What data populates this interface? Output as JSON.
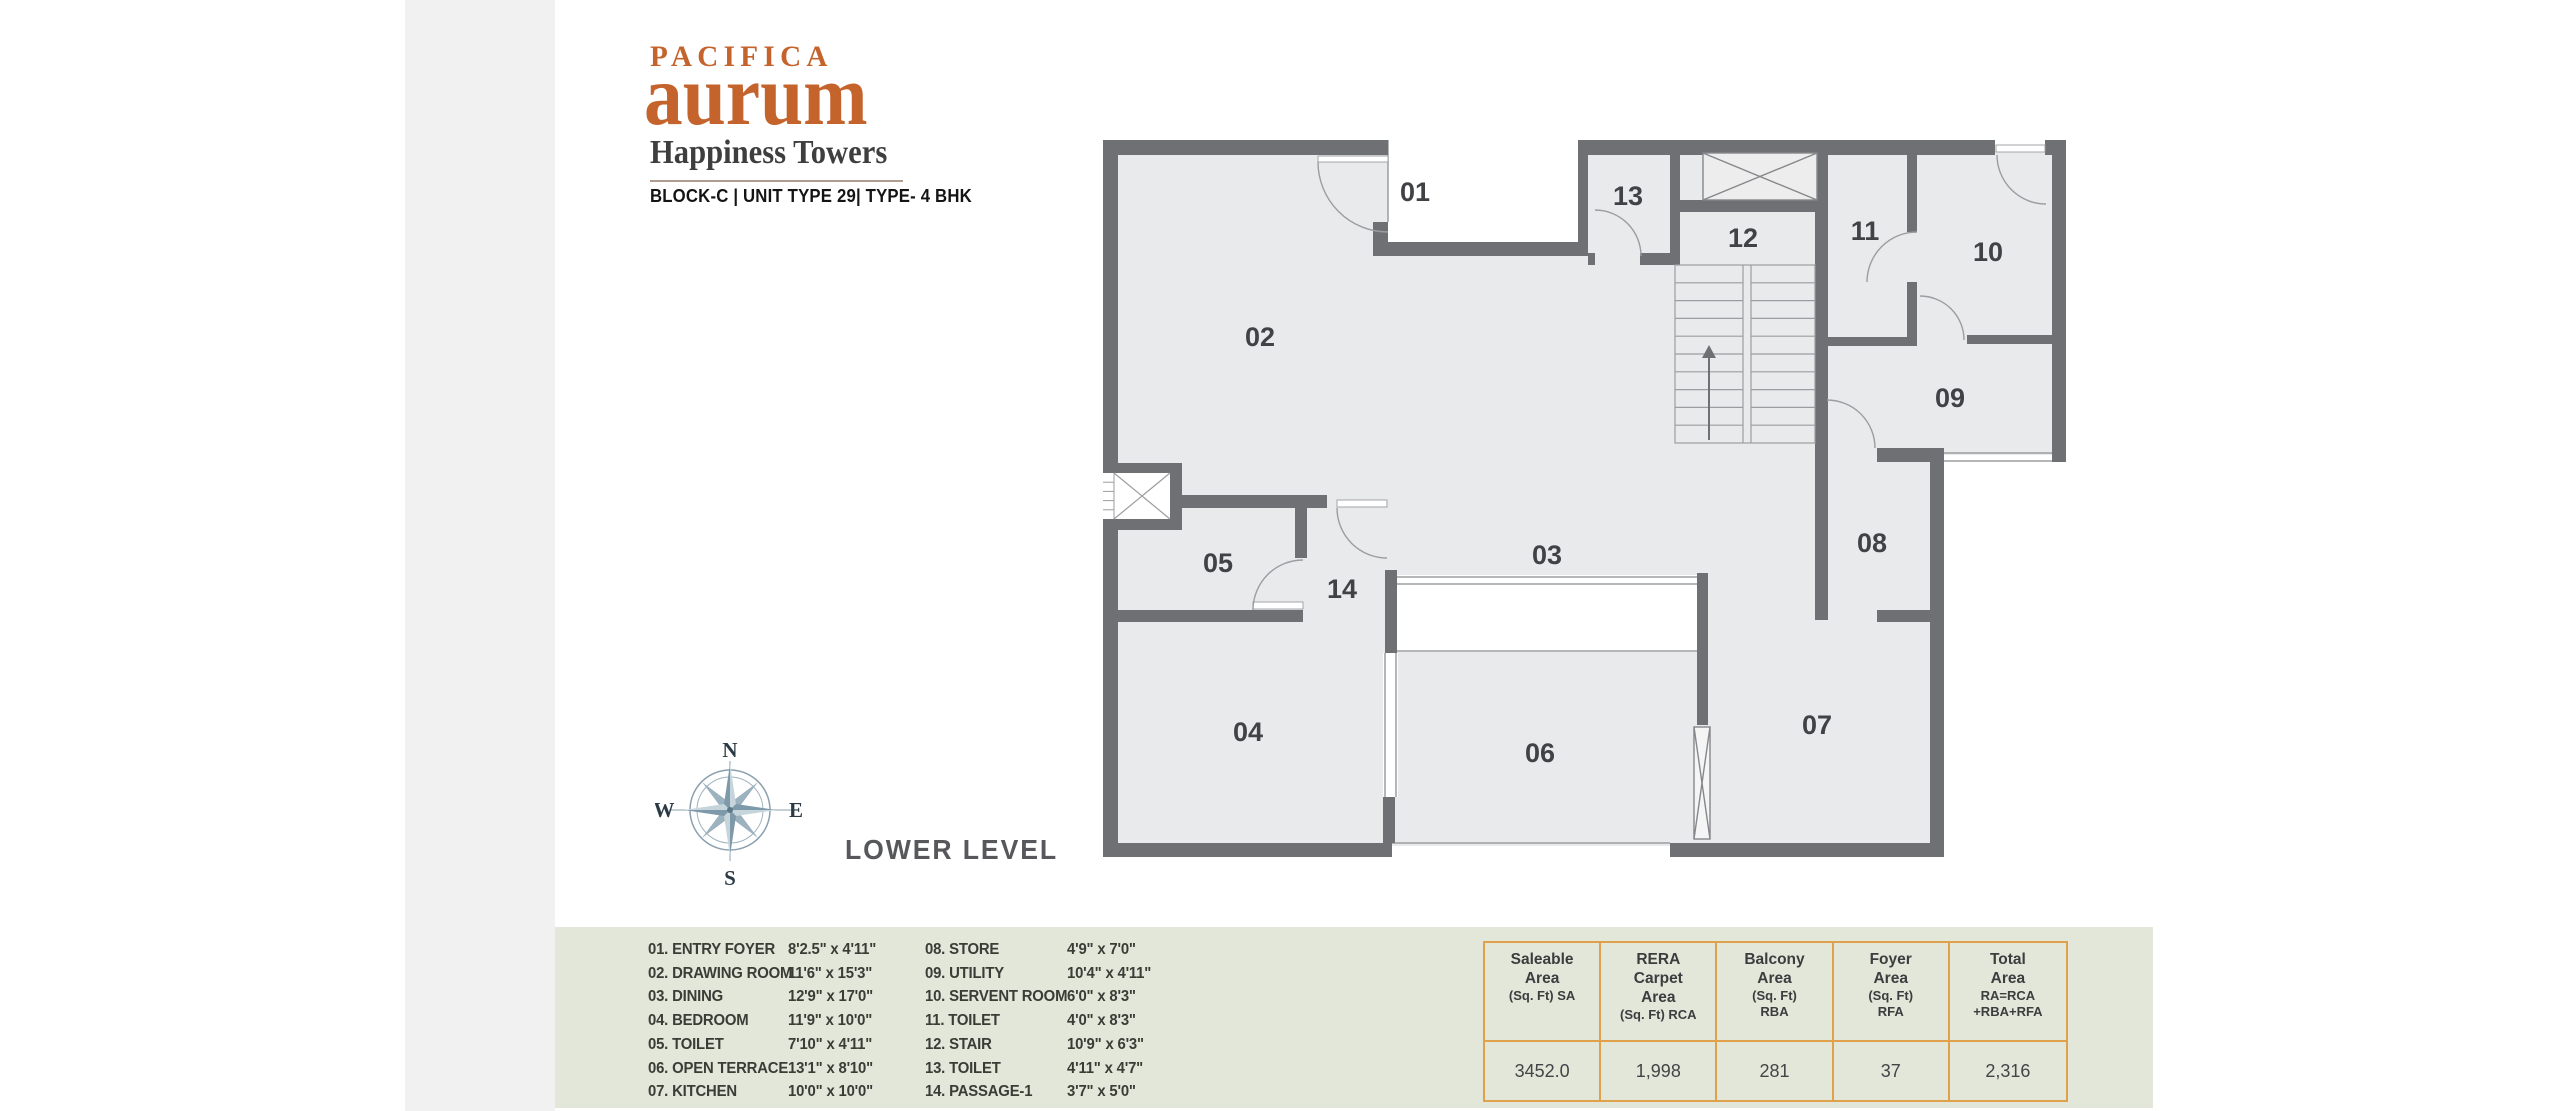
{
  "brand": {
    "line1": "PACIFICA",
    "line2": "aurum",
    "line3": "Happiness Towers",
    "line4": "BLOCK-C | UNIT TYPE 29| TYPE- 4 BHK"
  },
  "level_label": "LOWER LEVEL",
  "compass": {
    "n": "N",
    "e": "E",
    "s": "S",
    "w": "W"
  },
  "plan": {
    "rooms": [
      {
        "id": "01",
        "x": 1415,
        "y": 192
      },
      {
        "id": "02",
        "x": 1260,
        "y": 337
      },
      {
        "id": "03",
        "x": 1547,
        "y": 555
      },
      {
        "id": "04",
        "x": 1248,
        "y": 732
      },
      {
        "id": "05",
        "x": 1218,
        "y": 563
      },
      {
        "id": "06",
        "x": 1540,
        "y": 753
      },
      {
        "id": "07",
        "x": 1817,
        "y": 725
      },
      {
        "id": "08",
        "x": 1872,
        "y": 543
      },
      {
        "id": "09",
        "x": 1950,
        "y": 398
      },
      {
        "id": "10",
        "x": 1988,
        "y": 252
      },
      {
        "id": "11",
        "x": 1865,
        "y": 231
      },
      {
        "id": "12",
        "x": 1743,
        "y": 238
      },
      {
        "id": "13",
        "x": 1628,
        "y": 196
      },
      {
        "id": "14",
        "x": 1342,
        "y": 589
      }
    ]
  },
  "legend": {
    "left": [
      {
        "num": "01.",
        "name": "ENTRY FOYER",
        "dim": "8'2.5\" x 4'11\""
      },
      {
        "num": "02.",
        "name": "DRAWING ROOM",
        "dim": "11'6\" x 15'3\""
      },
      {
        "num": "03.",
        "name": "DINING",
        "dim": "12'9\" x 17'0\""
      },
      {
        "num": "04.",
        "name": "BEDROOM",
        "dim": "11'9\" x 10'0\""
      },
      {
        "num": "05.",
        "name": "TOILET",
        "dim": "7'10\" x 4'11\""
      },
      {
        "num": "06.",
        "name": "OPEN TERRACE",
        "dim": "13'1\" x 8'10\""
      },
      {
        "num": "07.",
        "name": "KITCHEN",
        "dim": "10'0\" x 10'0\""
      }
    ],
    "right": [
      {
        "num": "08.",
        "name": "STORE",
        "dim": "4'9\" x 7'0\""
      },
      {
        "num": "09.",
        "name": "UTILITY",
        "dim": "10'4\" x 4'11\""
      },
      {
        "num": "10.",
        "name": "SERVENT ROOM",
        "dim": "6'0\" x 8'3\""
      },
      {
        "num": "11.",
        "name": "TOILET",
        "dim": "4'0\" x 8'3\""
      },
      {
        "num": "12.",
        "name": "STAIR",
        "dim": "10'9\" x 6'3\""
      },
      {
        "num": "13.",
        "name": "TOILET",
        "dim": "4'11\" x 4'7\""
      },
      {
        "num": "14.",
        "name": "PASSAGE-1",
        "dim": "3'7\" x 5'0\""
      }
    ]
  },
  "area_table": {
    "columns": [
      {
        "title_lines": [
          "Saleable",
          "Area"
        ],
        "sub_lines": [
          "(Sq. Ft) SA"
        ],
        "value": "3452.0"
      },
      {
        "title_lines": [
          "RERA",
          "Carpet",
          "Area"
        ],
        "sub_lines": [
          "(Sq. Ft) RCA"
        ],
        "value": "1,998"
      },
      {
        "title_lines": [
          "Balcony",
          "Area"
        ],
        "sub_lines": [
          "(Sq. Ft)",
          "RBA"
        ],
        "value": "281"
      },
      {
        "title_lines": [
          "Foyer",
          "Area"
        ],
        "sub_lines": [
          "(Sq. Ft)",
          "RFA"
        ],
        "value": "37"
      },
      {
        "title_lines": [
          "Total",
          "Area"
        ],
        "sub_lines": [
          "RA=RCA",
          "+RBA+RFA"
        ],
        "value": "2,316"
      }
    ]
  },
  "colors": {
    "accent_orange": "#c4632c",
    "table_border": "#dfa14c",
    "wall_gray": "#6f7073",
    "floor_gray": "#e9eaeb",
    "band_bg": "#e3e7da",
    "strip_bg": "#f1f1f2",
    "compass_blue": "#9db2bf"
  }
}
